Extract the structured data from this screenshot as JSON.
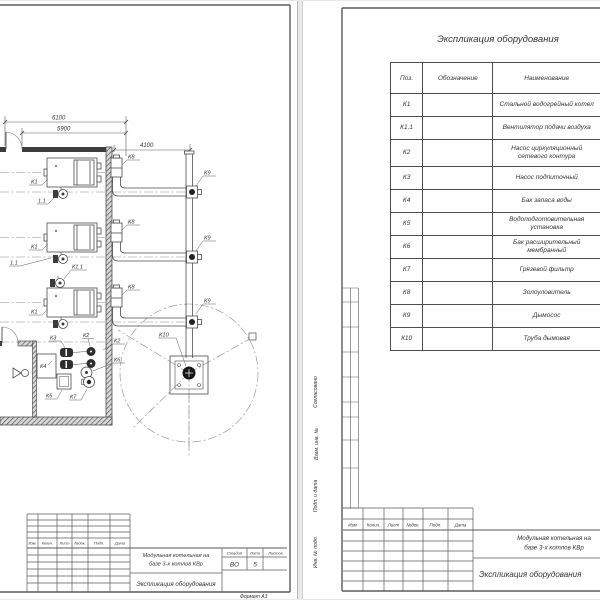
{
  "plan": {
    "dimensions": {
      "overall_width": "6100",
      "inner_width": "5900",
      "flue_offset": "4100"
    },
    "labels": {
      "boiler": "К1",
      "fan_full": "К1.1",
      "fan_short": "1.1",
      "network_pump": "К2",
      "feed_pump": "К3",
      "water_tank": "К4",
      "water_treatment": "К5",
      "expansion_tank": "К6",
      "mud_filter": "К7",
      "ash_collector": "К8",
      "smoke_exhauster": "К9",
      "chimney": "К10"
    }
  },
  "left_stamp": {
    "header_cols": [
      "Изм.",
      "Колич.",
      "Лист",
      "№док.",
      "Подп.",
      "Дата"
    ],
    "project_line1": "Модульная котельная на",
    "project_line2": "базе 3-х котлов КВр",
    "doc_title": "Экспликация оборудования",
    "stage_label": "Стадия",
    "sheet_label": "Лист",
    "sheets_label": "Листов",
    "stage": "ВО",
    "sheet_no": "5",
    "format_note": "Формат А3"
  },
  "right_sheet": {
    "table_title": "Экспликация оборудования",
    "table": {
      "col_pos": "Поз.",
      "col_designation": "Обозначение",
      "col_name": "Наименование",
      "rows": [
        {
          "pos": "К1",
          "name": "Стальной водогрейный котел"
        },
        {
          "pos": "К1.1",
          "name": "Вентилятор подачи воздуха"
        },
        {
          "pos": "К2",
          "name": "Насос циркуляционный\nсетевого контура"
        },
        {
          "pos": "К3",
          "name": "Насос подпиточный"
        },
        {
          "pos": "К4",
          "name": "Бак запаса воды"
        },
        {
          "pos": "К5",
          "name": "Водоподготовительная установка"
        },
        {
          "pos": "К6",
          "name": "Бак расширительный мембранный"
        },
        {
          "pos": "К7",
          "name": "Грязевой фильтр"
        },
        {
          "pos": "К8",
          "name": "Золоуловитель"
        },
        {
          "pos": "К9",
          "name": "Дымосос"
        },
        {
          "pos": "К10",
          "name": "Труба дымовая"
        }
      ]
    },
    "stamp": {
      "header_cols": [
        "Изм.",
        "Колич.",
        "Лист",
        "№док.",
        "Подп.",
        "Дата"
      ],
      "project_line1": "Модульная котельная на",
      "project_line2": "базе 3-х котлов КВр",
      "doc_title": "Экспликация оборудования"
    },
    "margin_labels": {
      "approved": "Согласовано",
      "replace": "Взам. инв. №",
      "sign_date": "Подп. и дата",
      "inv": "Инв. № подл."
    }
  }
}
